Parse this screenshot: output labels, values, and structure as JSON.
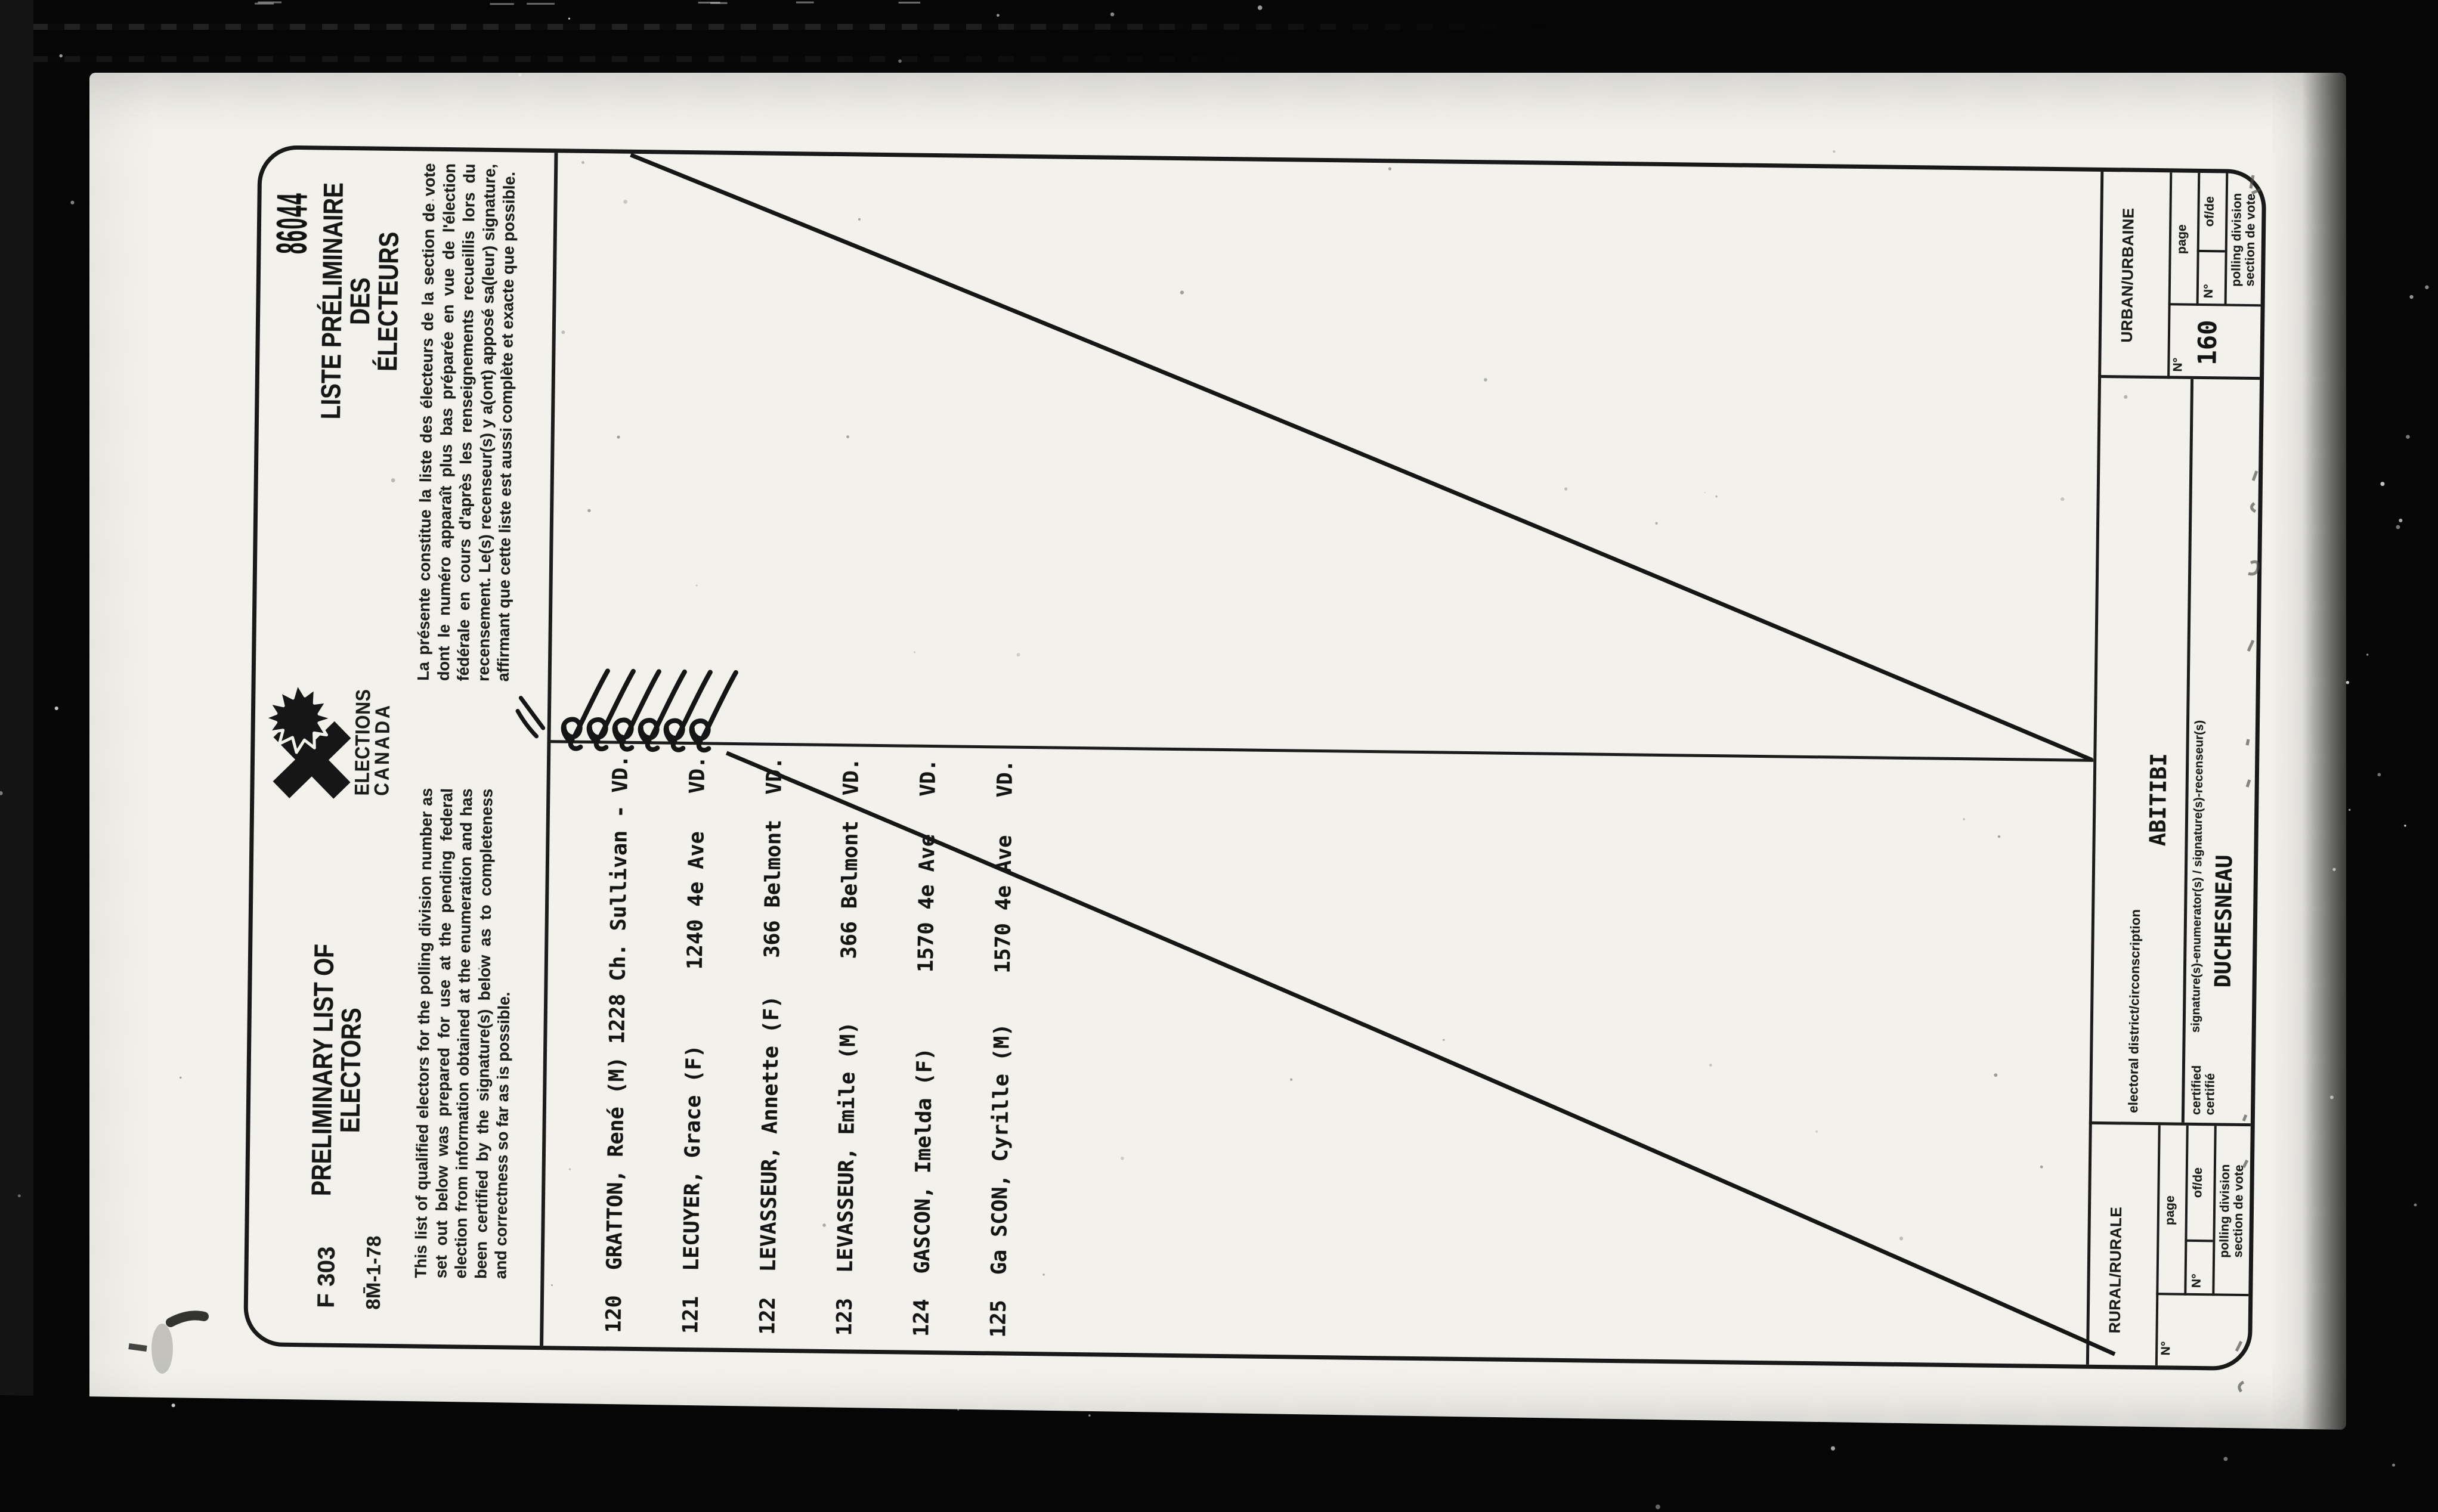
{
  "stamp_number": "86044",
  "header": {
    "form_code": "F 303",
    "print_code": "8M̄-1-78",
    "title_en_line1": "PRELIMINARY LIST OF",
    "title_en_line2": "ELECTORS",
    "paragraph_en": "This list of qualified electors for the polling division number as set out below was prepared for use at the pending federal election from information obtained at the enumeration and has been certified by the signature(s) below as to completeness and correctness so far as is possible.",
    "logo_line1": "ELECTIONS",
    "logo_line2": "CANADA",
    "title_fr_line1": "LISTE PRÉLIMINAIRE DES",
    "title_fr_line2": "ÉLECTEURS",
    "paragraph_fr": "La présente constitue la liste des électeurs de la section de vote dont le numéro apparaît plus bas préparée en vue de l'élection fédérale en cours d'après les renseignements recueillis lors du recensement. Le(s) recenseur(s) y a(ont) apposé sa(leur) signature, affirmant que cette liste est aussi complète et exacte que possible."
  },
  "electors": [
    "120  GRATTON, René (M) 1228 Ch. Sullivan - VD.",
    "121  LECUYER, Grace (F)      1240 4e Ave   VD.",
    "122  LEVASSEUR, Annette (F)   366 Belmont  VD.",
    "123  LEVASSEUR, Emile (M)     366 Belmont  VD.",
    "124  GASCON, Imelda (F)      1570 4e Ave   VD.",
    "125  Ga SCON, Cyrille (M)    1570 4e Ave   VD."
  ],
  "footer": {
    "rural": {
      "title": "RURAL/RURALE",
      "no_label": "N°",
      "page_label": "page",
      "page_no_label": "N°",
      "ofde_label": "of/de",
      "caption_line1": "polling division",
      "caption_line2": "section de vote"
    },
    "district_label": "electoral district/circonscription",
    "district_value": "ABITIBI",
    "certified_line1": "certified",
    "certified_line2": "certifié",
    "signature_caption": "signature(s)-enumerator(s) / signature(s)-recenseur(s)",
    "signature_value": "DUCHESNEAU",
    "urban": {
      "title": "URBAN/URBAINE",
      "no_label": "N°",
      "page_label": "page",
      "page_no_label": "N°",
      "ofde_label": "of/de",
      "number_value": "160",
      "caption_line1": "polling division",
      "caption_line2": "section de vote"
    }
  }
}
